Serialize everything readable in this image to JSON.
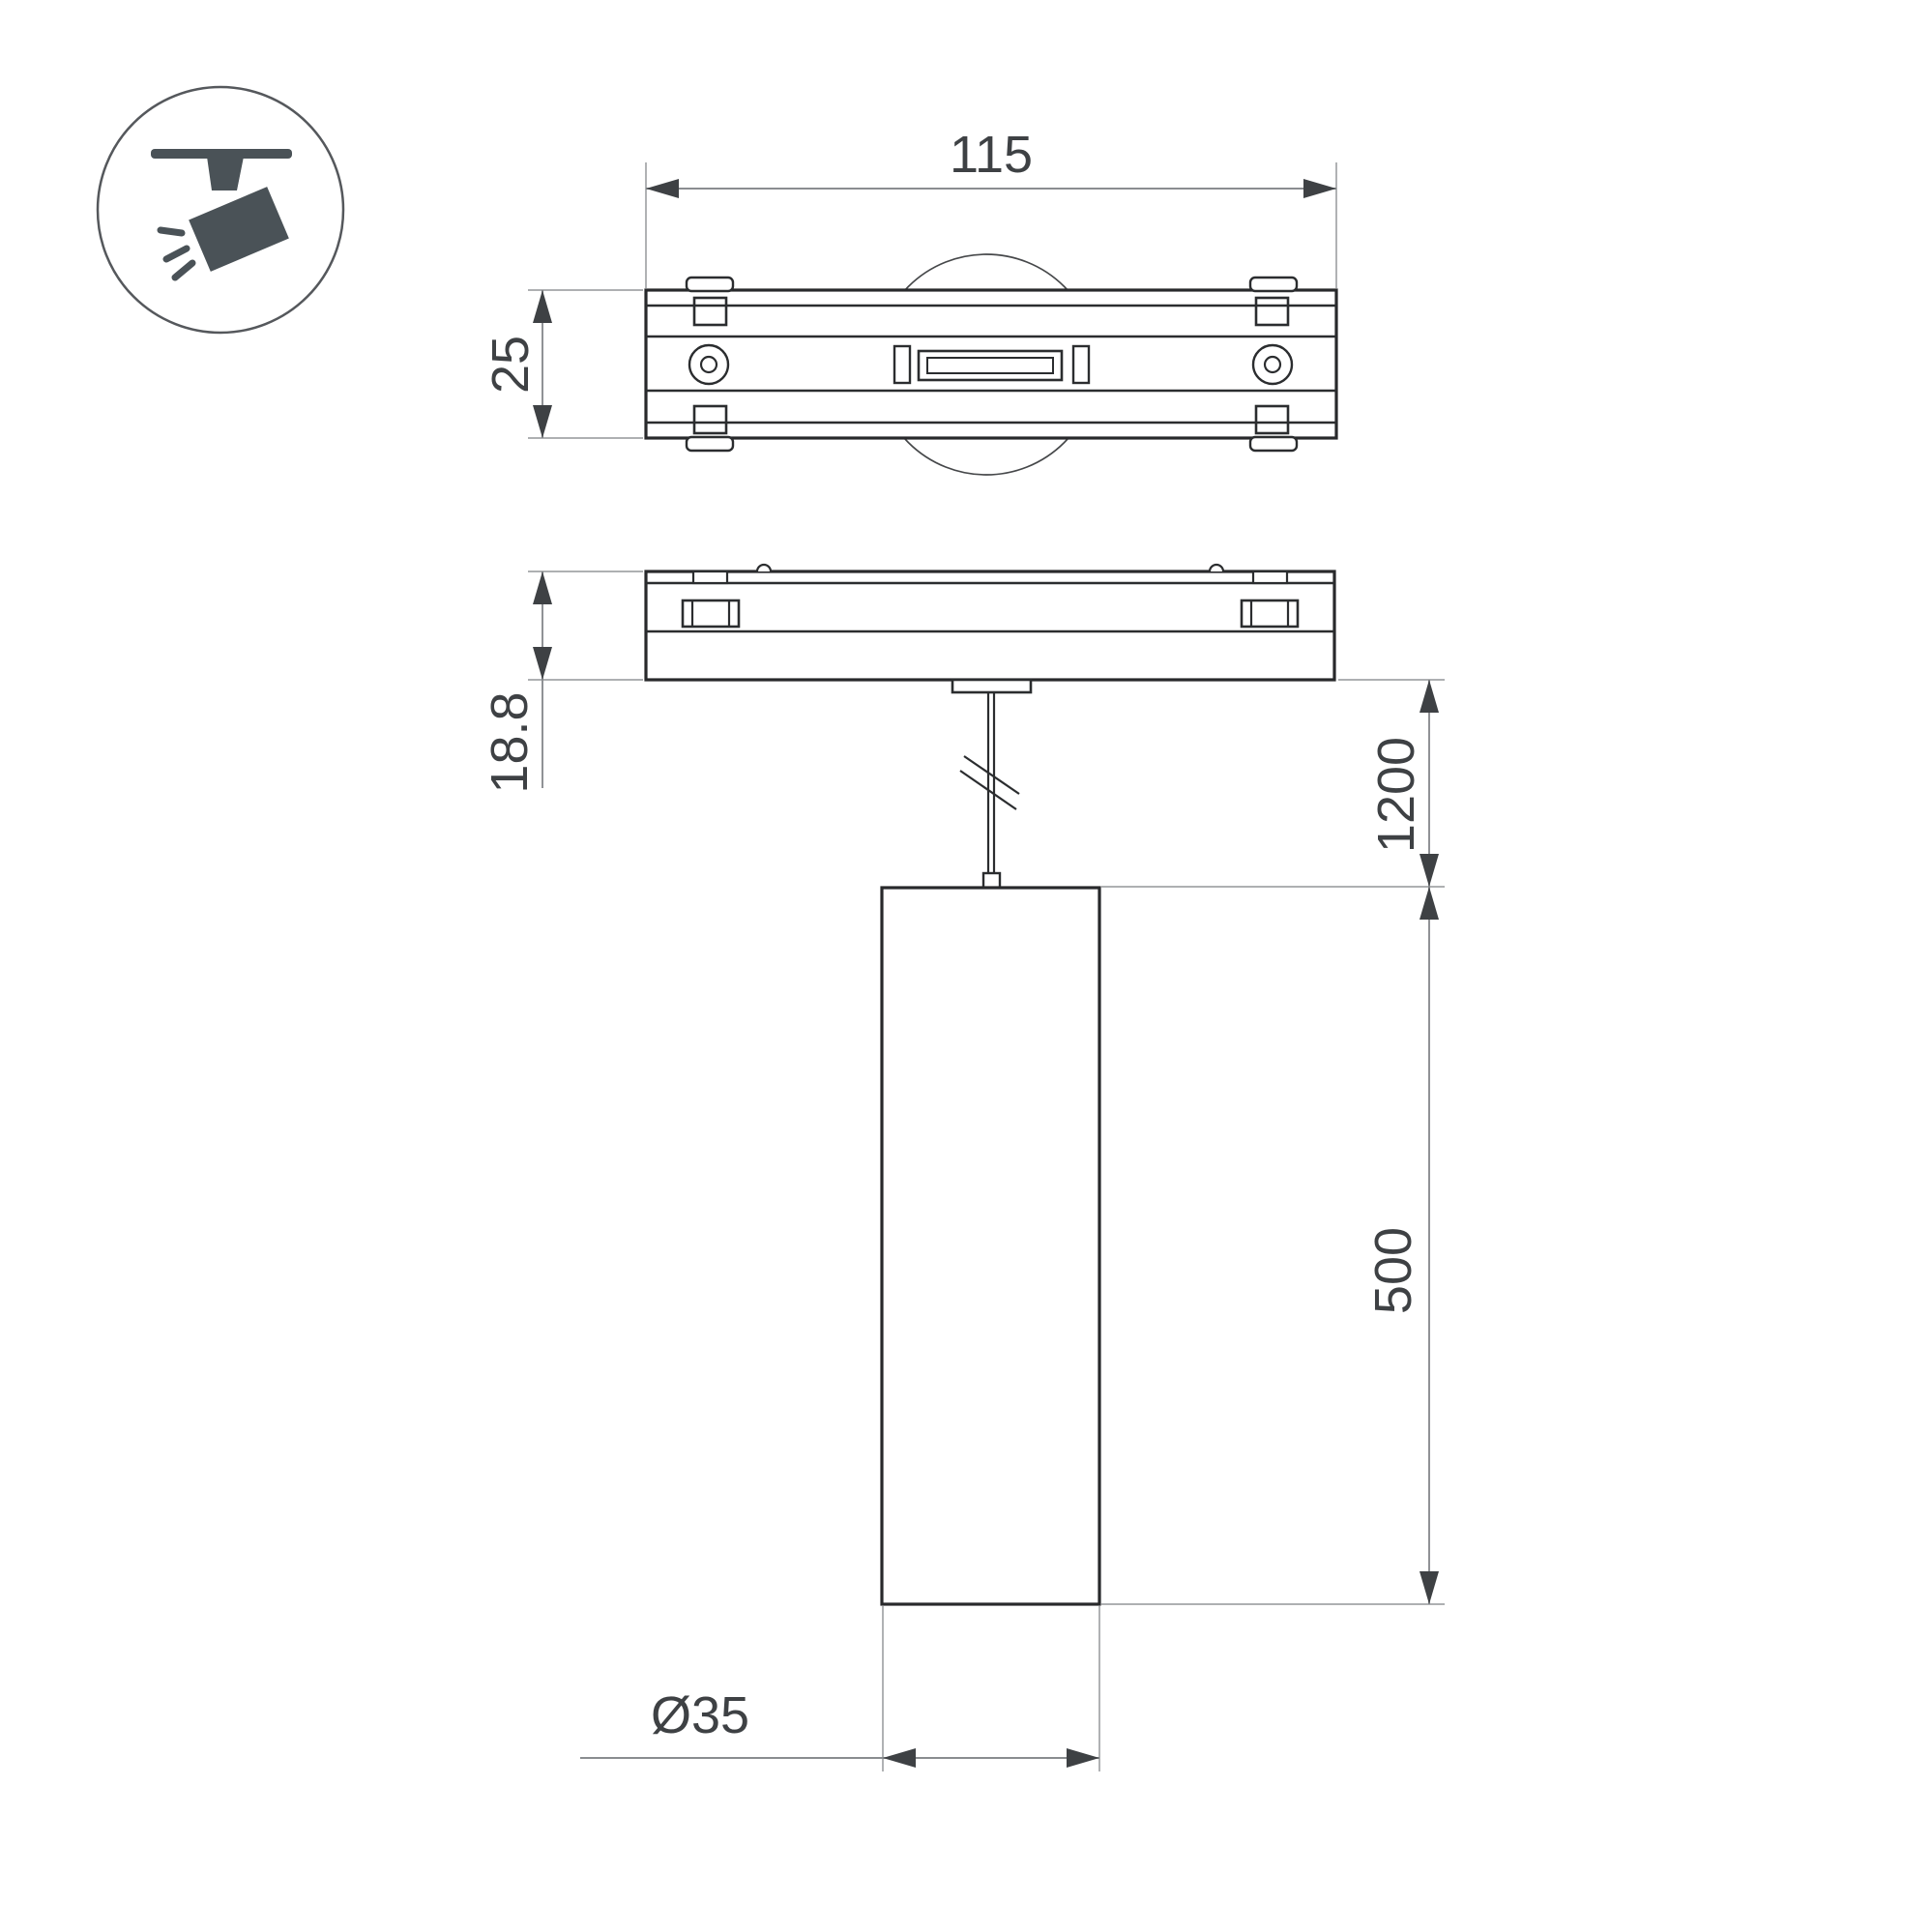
{
  "drawing": {
    "type": "technical-dimension-drawing",
    "product": "magnetic-track-pendant-spot-luminaire",
    "colors": {
      "background": "#ffffff",
      "outline": "#28292b",
      "detail_line": "#2b2d2f",
      "extension_line": "#a3a5a7",
      "dimension_line": "#8a8d90",
      "arrow_and_text": "#3e4144",
      "icon_fill": "#4a5257",
      "icon_circle_stroke": "#55585c"
    },
    "icon": {
      "name": "track-spotlight-icon",
      "description": "ceiling track with tilted spotlight head and light rays"
    },
    "dimensions": {
      "track_width": {
        "label": "115"
      },
      "track_depth": {
        "label": "25"
      },
      "base_height": {
        "label": "18.8"
      },
      "suspension_length": {
        "label": "1200"
      },
      "body_length": {
        "label": "500"
      },
      "body_diameter": {
        "label": "Ø35"
      }
    }
  }
}
